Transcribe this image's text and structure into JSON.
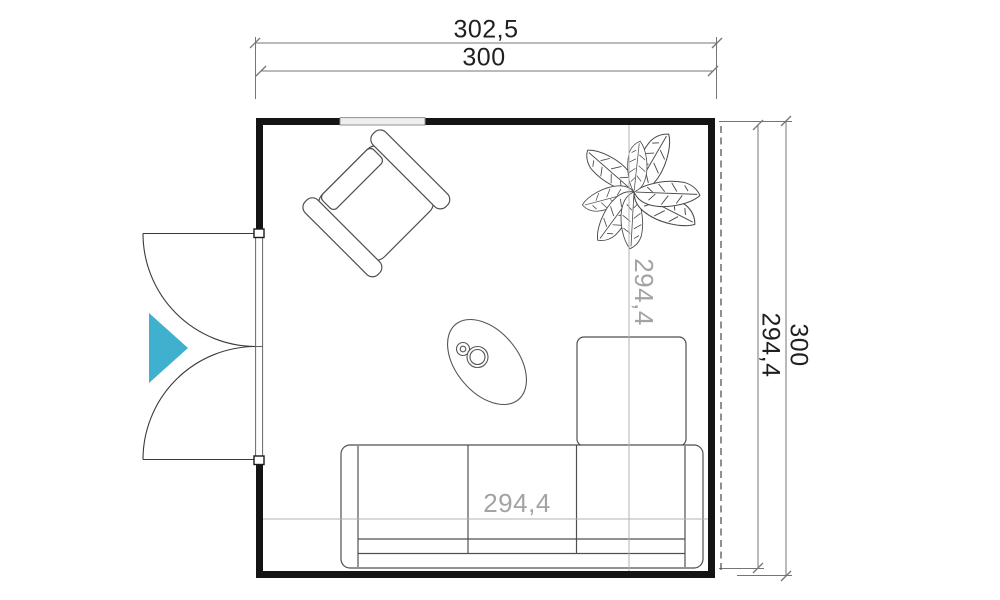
{
  "floorplan": {
    "dimensions": {
      "top_outer": "302,5",
      "top_inner": "300",
      "right_outer": "300",
      "right_inner": "294,4",
      "interior_width": "294,4",
      "interior_height": "294,4"
    },
    "colors": {
      "door_swing_accent": "#3fb0ce",
      "wall": "#141414",
      "dimension_line": "#757575",
      "interior_dimension_text": "#a3a3a3"
    },
    "furniture": [
      "armchair",
      "plant",
      "coffee-table",
      "corner-sofa"
    ],
    "features": [
      "double-door",
      "window",
      "roof-overhang-dashed-line"
    ]
  }
}
